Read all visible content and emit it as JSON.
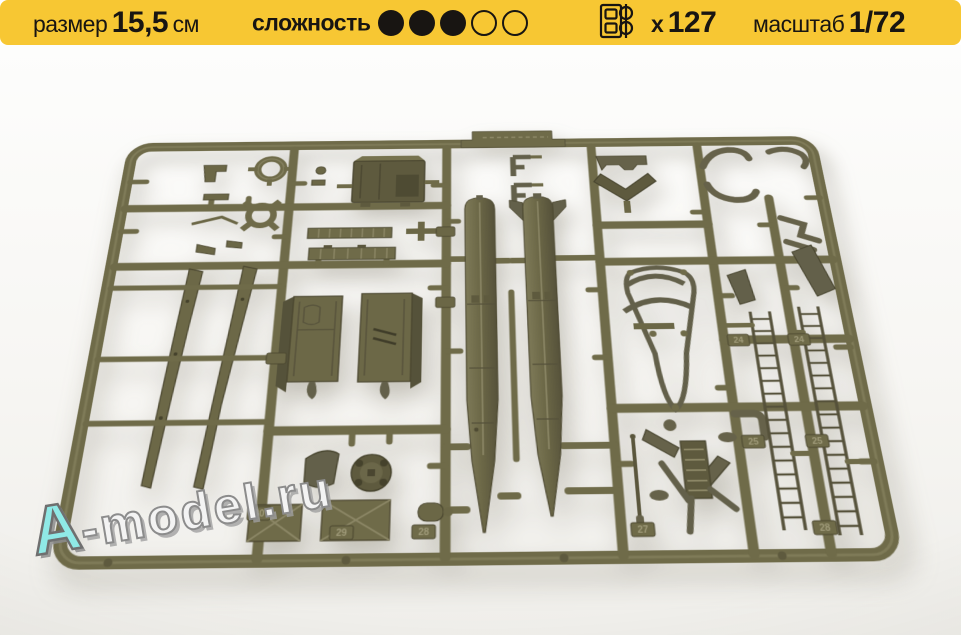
{
  "banner": {
    "size": {
      "label": "размер",
      "value": "15,5",
      "unit": "см"
    },
    "difficulty": {
      "label": "сложность",
      "filled": 3,
      "total": 5
    },
    "parts_count": {
      "prefix": "х",
      "value": "127"
    },
    "scale": {
      "label": "масштаб",
      "value": "1/72"
    },
    "colors": {
      "background": "#F7C733",
      "text": "#181512"
    }
  },
  "icons": {
    "parts_count_icon": "sprue-icon"
  },
  "photo": {
    "plastic_color": "#6F6B49",
    "plastic_highlight": "#8C8766",
    "plastic_shadow": "#45422C",
    "background_color": "#F7F6F3",
    "watermark": {
      "lead": "A",
      "rest": "-model.ru",
      "lead_color": "#8FE9E6"
    },
    "part_tags": [
      "30",
      "29",
      "28",
      "27",
      "28",
      "25",
      "25",
      "24",
      "24"
    ]
  }
}
